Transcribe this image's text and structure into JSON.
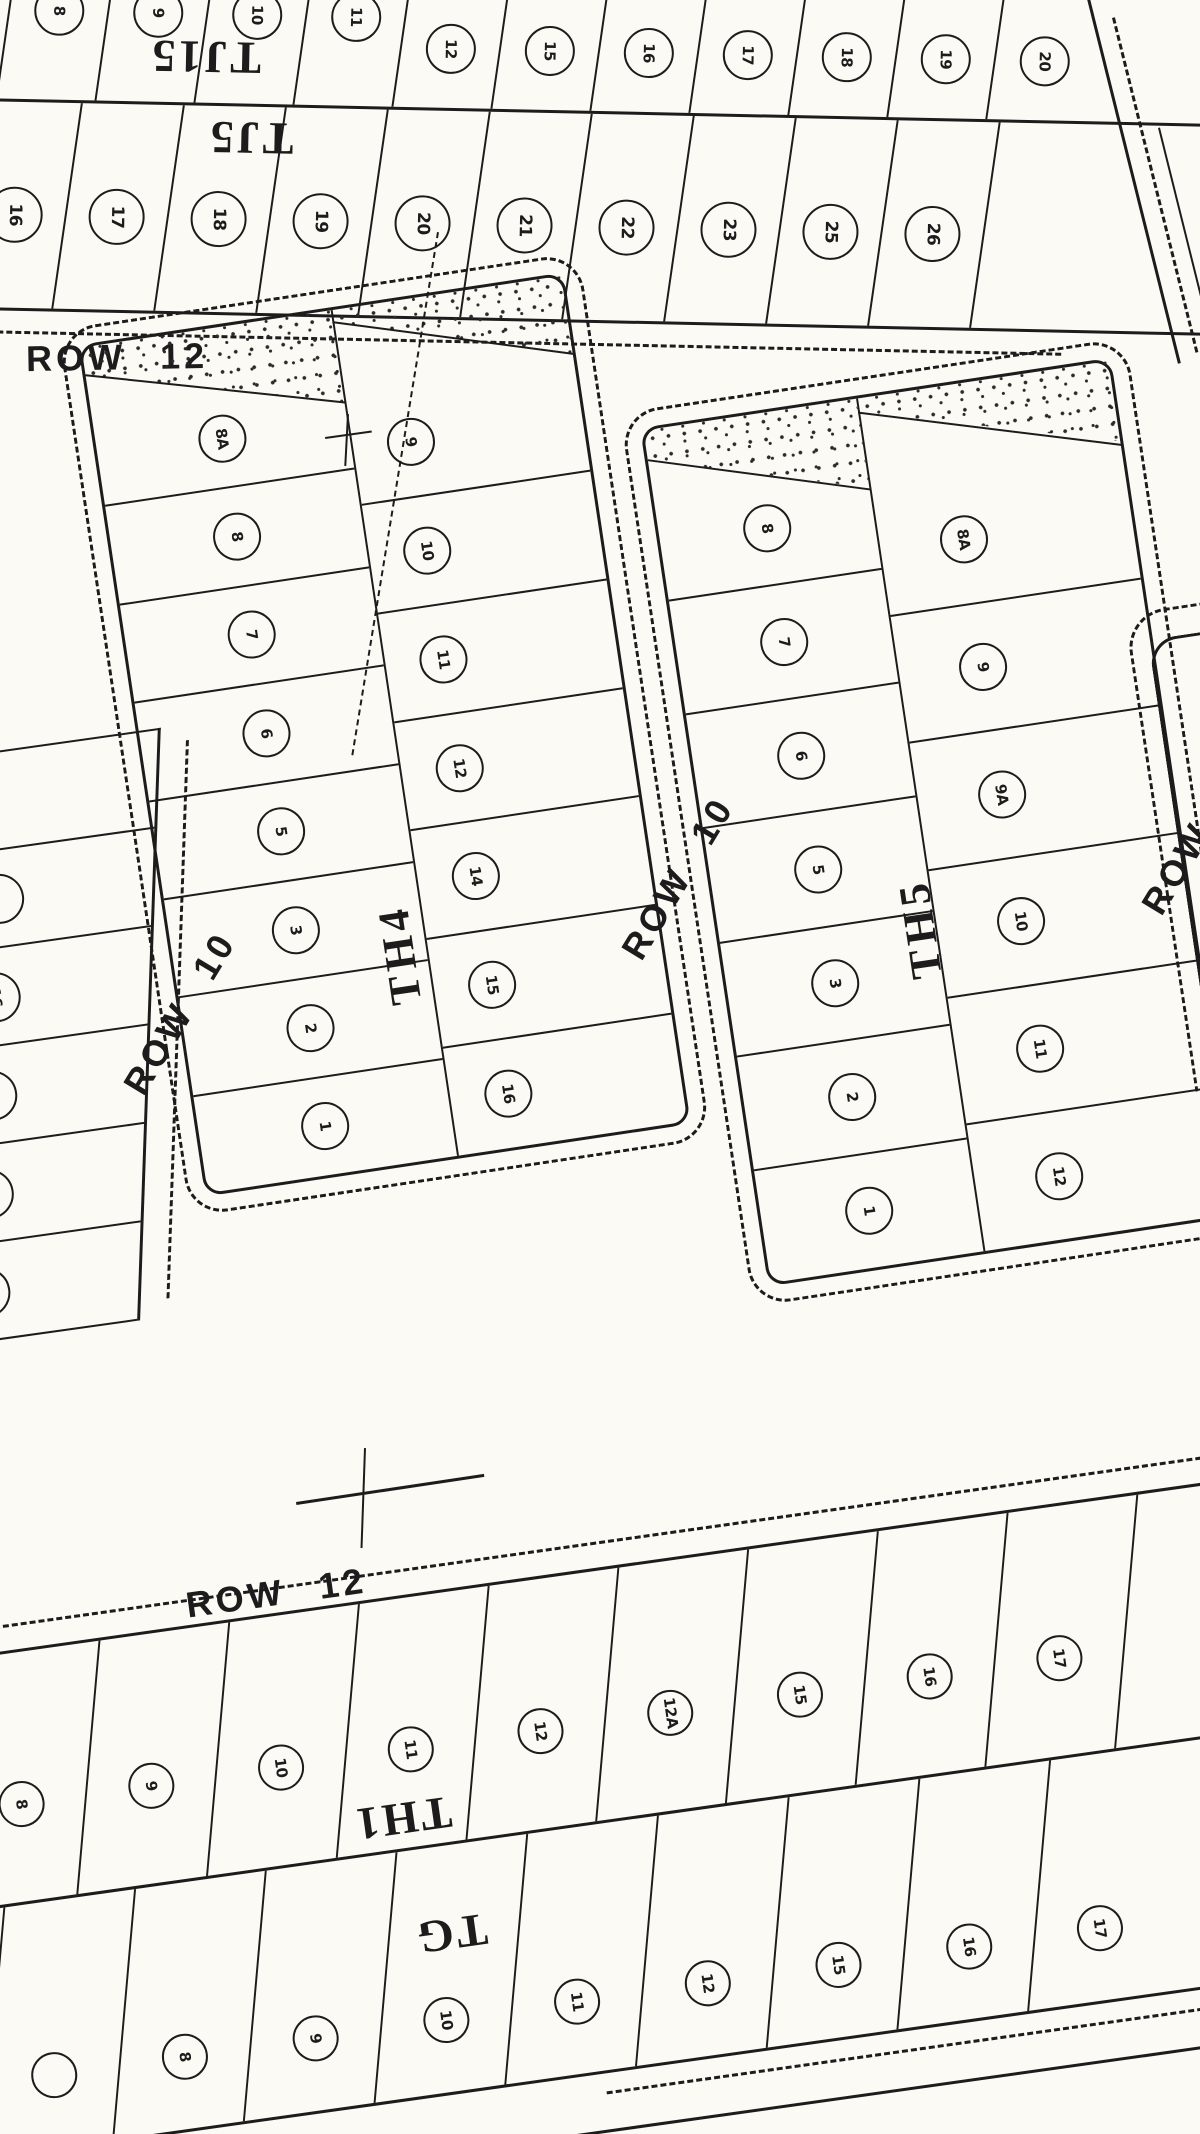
{
  "ink": "#1c1c1c",
  "paper": "#fbfaf5",
  "streets": {
    "row12_top": "ROW 12",
    "row10_left": "ROW 10",
    "row10_mid": "ROW 10",
    "row12_right": "ROW 12",
    "row12_bottom": "ROW 12"
  },
  "blocks": {
    "tj15": {
      "label": "TJ15",
      "cells": [
        {
          "n": "8",
          "cls": "hi"
        },
        {
          "n": "9",
          "cls": "hi"
        },
        {
          "n": "10",
          "cls": "hi"
        },
        {
          "n": "11",
          "cls": "hi"
        },
        {
          "n": "12"
        },
        {
          "n": "15"
        },
        {
          "n": "16"
        },
        {
          "n": "17"
        },
        {
          "n": "18"
        },
        {
          "n": "19"
        },
        {
          "n": "20"
        }
      ]
    },
    "tj5": {
      "label": "TJ5",
      "cells": [
        {
          "n": "16"
        },
        {
          "n": "17"
        },
        {
          "n": "18"
        },
        {
          "n": "19"
        },
        {
          "n": "20"
        },
        {
          "n": "21"
        },
        {
          "n": "22"
        },
        {
          "n": "23"
        },
        {
          "n": "25"
        },
        {
          "n": "26"
        },
        {
          "n": "",
          "cls": "noc"
        }
      ]
    },
    "left_partial": {
      "cells": [
        {
          "n": "",
          "cls": "noc"
        },
        {
          "n": ""
        },
        {
          "n": "16"
        },
        {
          "n": "17"
        },
        {
          "n": "18"
        },
        {
          "n": "19"
        }
      ]
    },
    "th4": {
      "label": "TH4",
      "left_cells": [
        {
          "n": "8A"
        },
        {
          "n": "8"
        },
        {
          "n": "7"
        },
        {
          "n": "6"
        },
        {
          "n": "5"
        },
        {
          "n": "3"
        },
        {
          "n": "2"
        },
        {
          "n": "1"
        }
      ],
      "right_cells": [
        {
          "n": "9"
        },
        {
          "n": "10"
        },
        {
          "n": "11"
        },
        {
          "n": "12"
        },
        {
          "n": "14"
        },
        {
          "n": "15"
        },
        {
          "n": "16"
        }
      ]
    },
    "th5": {
      "label": "TH5",
      "left_cells": [
        {
          "n": "8"
        },
        {
          "n": "7"
        },
        {
          "n": "6"
        },
        {
          "n": "5"
        },
        {
          "n": "3"
        },
        {
          "n": "2"
        },
        {
          "n": "1"
        }
      ],
      "right_cells": [
        {
          "n": "8A"
        },
        {
          "n": "9"
        },
        {
          "n": "9A"
        },
        {
          "n": "10"
        },
        {
          "n": "11"
        },
        {
          "n": "12"
        }
      ]
    },
    "th1": {
      "label": "TH1",
      "cells": [
        {
          "n": "8"
        },
        {
          "n": "9"
        },
        {
          "n": "10"
        },
        {
          "n": "11"
        },
        {
          "n": "12"
        },
        {
          "n": "12A"
        },
        {
          "n": "15"
        },
        {
          "n": "16"
        },
        {
          "n": "17"
        },
        {
          "n": "",
          "cls": "noc"
        }
      ]
    },
    "tg": {
      "label": "TG",
      "cells": [
        {
          "n": ""
        },
        {
          "n": "8"
        },
        {
          "n": "9"
        },
        {
          "n": "10"
        },
        {
          "n": "11"
        },
        {
          "n": "12"
        },
        {
          "n": "15"
        },
        {
          "n": "16"
        },
        {
          "n": "17"
        }
      ]
    }
  }
}
